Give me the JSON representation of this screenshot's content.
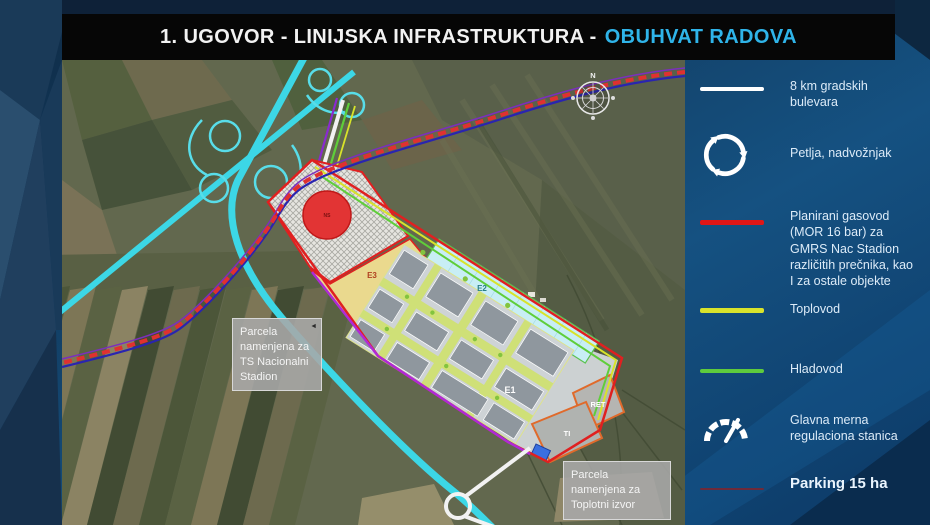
{
  "title": {
    "part1": "1. UGOVOR - LINIJSKA INFRASTRUKTURA -",
    "part2": "OBUHVAT RADOVA",
    "highlight_color": "#2fb4e9"
  },
  "legend": {
    "items": [
      {
        "id": "bulevari",
        "symbol": "line",
        "color": "#ffffff",
        "label": "8 km gradskih bulevara"
      },
      {
        "id": "petlja",
        "symbol": "loop-arrows-icon",
        "color": "#ffffff",
        "label": "Petlja, nadvožnjak"
      },
      {
        "id": "gasovod",
        "symbol": "line",
        "color": "#e01616",
        "label": "Planirani gasovod (MOR 16 bar) za GMRS Nac Stadion različitih prečnika, kao I za ostale objekte"
      },
      {
        "id": "toplovod",
        "symbol": "line",
        "color": "#d9e32b",
        "label": "Toplovod"
      },
      {
        "id": "hladovod",
        "symbol": "line",
        "color": "#5ecb3d",
        "label": "Hladovod"
      },
      {
        "id": "gmrs",
        "symbol": "gauge-icon",
        "color": "#ffffff",
        "label": "Glavna merna regulaciona stanica"
      },
      {
        "id": "parking",
        "symbol": "line",
        "color": "#6e2a3a",
        "label": "Parking 15 ha"
      }
    ]
  },
  "map": {
    "compass": "N",
    "labels": {
      "ns": "NS",
      "e3": "E3",
      "e2": "E2",
      "e1": "E1",
      "ret": "RET",
      "ti": "TI"
    },
    "callouts": [
      {
        "id": "ts-stadion",
        "text": "Parcela namenjena za TS Nacionalni Stadion"
      },
      {
        "id": "toplotni-izvor",
        "text": "Parcela namenjena za Toplotni izvor"
      }
    ],
    "line_colors": {
      "highway_cyan": "#3cd7e6",
      "bulevar_white": "#f2f2f2",
      "gasovod_red": "#e03030",
      "gasovod_companion_blue": "#2a24b0",
      "toplovod_yellow": "#d8e32a",
      "hladovod_green": "#5fce3a",
      "parking_purple": "#b02ad6",
      "site_boundary_red": "#e02020",
      "parcel_orange": "#e06a2b"
    }
  }
}
